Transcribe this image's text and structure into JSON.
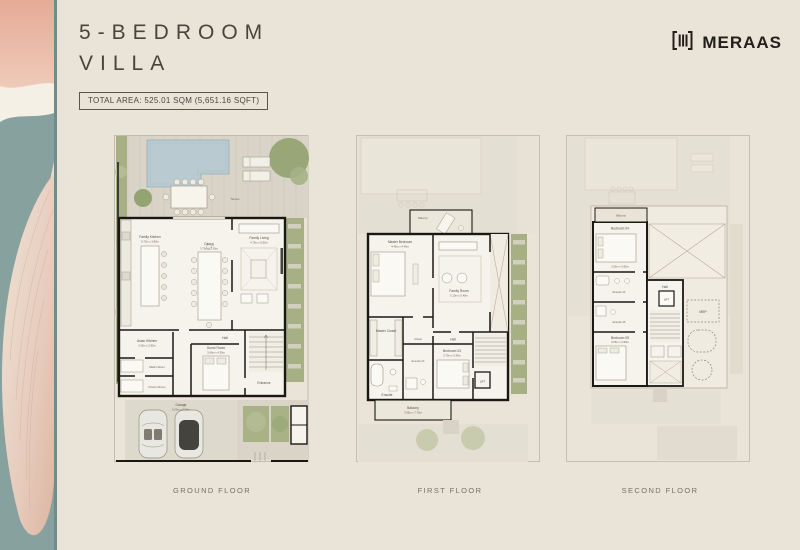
{
  "header": {
    "title_line1": "5-BEDROOM",
    "title_line2": "VILLA",
    "total_area": "TOTAL AREA: 525.01 SQM (5,651.16 SQFT)"
  },
  "brand": {
    "name": "MERAAS",
    "icon": "meraas-bars-icon"
  },
  "floors": {
    "ground": {
      "label": "GROUND FLOOR",
      "rooms": {
        "terrace": "Terrace",
        "family_kitchen": "Family Kitchen",
        "family_kitchen_dims": "5.75m x 3.80m",
        "dining": "Dining",
        "dining_dims": "3.75m x 7.30m",
        "family_living": "Family Living",
        "family_living_dims": "4.75m x 5.80m",
        "asian_kitchen": "Asian Kitchen",
        "asian_kitchen_dims": "3.30m x 2.85m",
        "maids_room": "Maid's Room",
        "drivers_room": "Driver's Room",
        "guest_room": "Guest Room",
        "guest_room_dims": "3.60m x 4.30m",
        "hall": "Hall",
        "entrance": "Entrance",
        "garage": "Garage",
        "garage_dims": "6.00m x 6.00m"
      }
    },
    "first": {
      "label": "FIRST FLOOR",
      "rooms": {
        "balcony": "Balcony",
        "master_bedroom": "Master Bedroom",
        "master_bedroom_dims": "4.45m x 4.45m",
        "master_closet": "Master Closet",
        "ensuite_master": "Ensuite",
        "family_room": "Family Room",
        "family_room_dims": "5.10m x 5.40m",
        "closet": "Closet",
        "bedroom_03": "Bedroom 03",
        "bedroom_03_dims": "3.70m x 5.45m",
        "ensuite_03": "Ensuite 03",
        "hall": "Hall",
        "lift": "LIFT",
        "balcony_rear": "Balcony",
        "balcony_rear_dims": "3.95m x 7.70m"
      }
    },
    "second": {
      "label": "SECOND FLOOR",
      "rooms": {
        "balcony": "Balcony",
        "bedroom_04": "Bedroom 04",
        "bedroom_04_dims": "3.05m x 3.80m",
        "ensuite_04": "Ensuite 04",
        "ensuite_05": "Ensuite 05",
        "bedroom_05": "Bedroom 05",
        "bedroom_05_dims": "3.65m x 4.50m",
        "hall": "Hall",
        "lift": "LIFT",
        "mep": "MEP"
      }
    }
  },
  "palette": {
    "page_bg": "#e9e3d8",
    "wall": "#1b1814",
    "pool": "#b9cbd1",
    "deck": "#d9d4c7",
    "green": "#a7b085",
    "interior": "#f6f3ec",
    "ghost": "#e4dfd3",
    "title_text": "#4a443b",
    "label_text": "#78705f",
    "strip_teal": "#87a19e",
    "strip_pink": "#e5ab96"
  }
}
